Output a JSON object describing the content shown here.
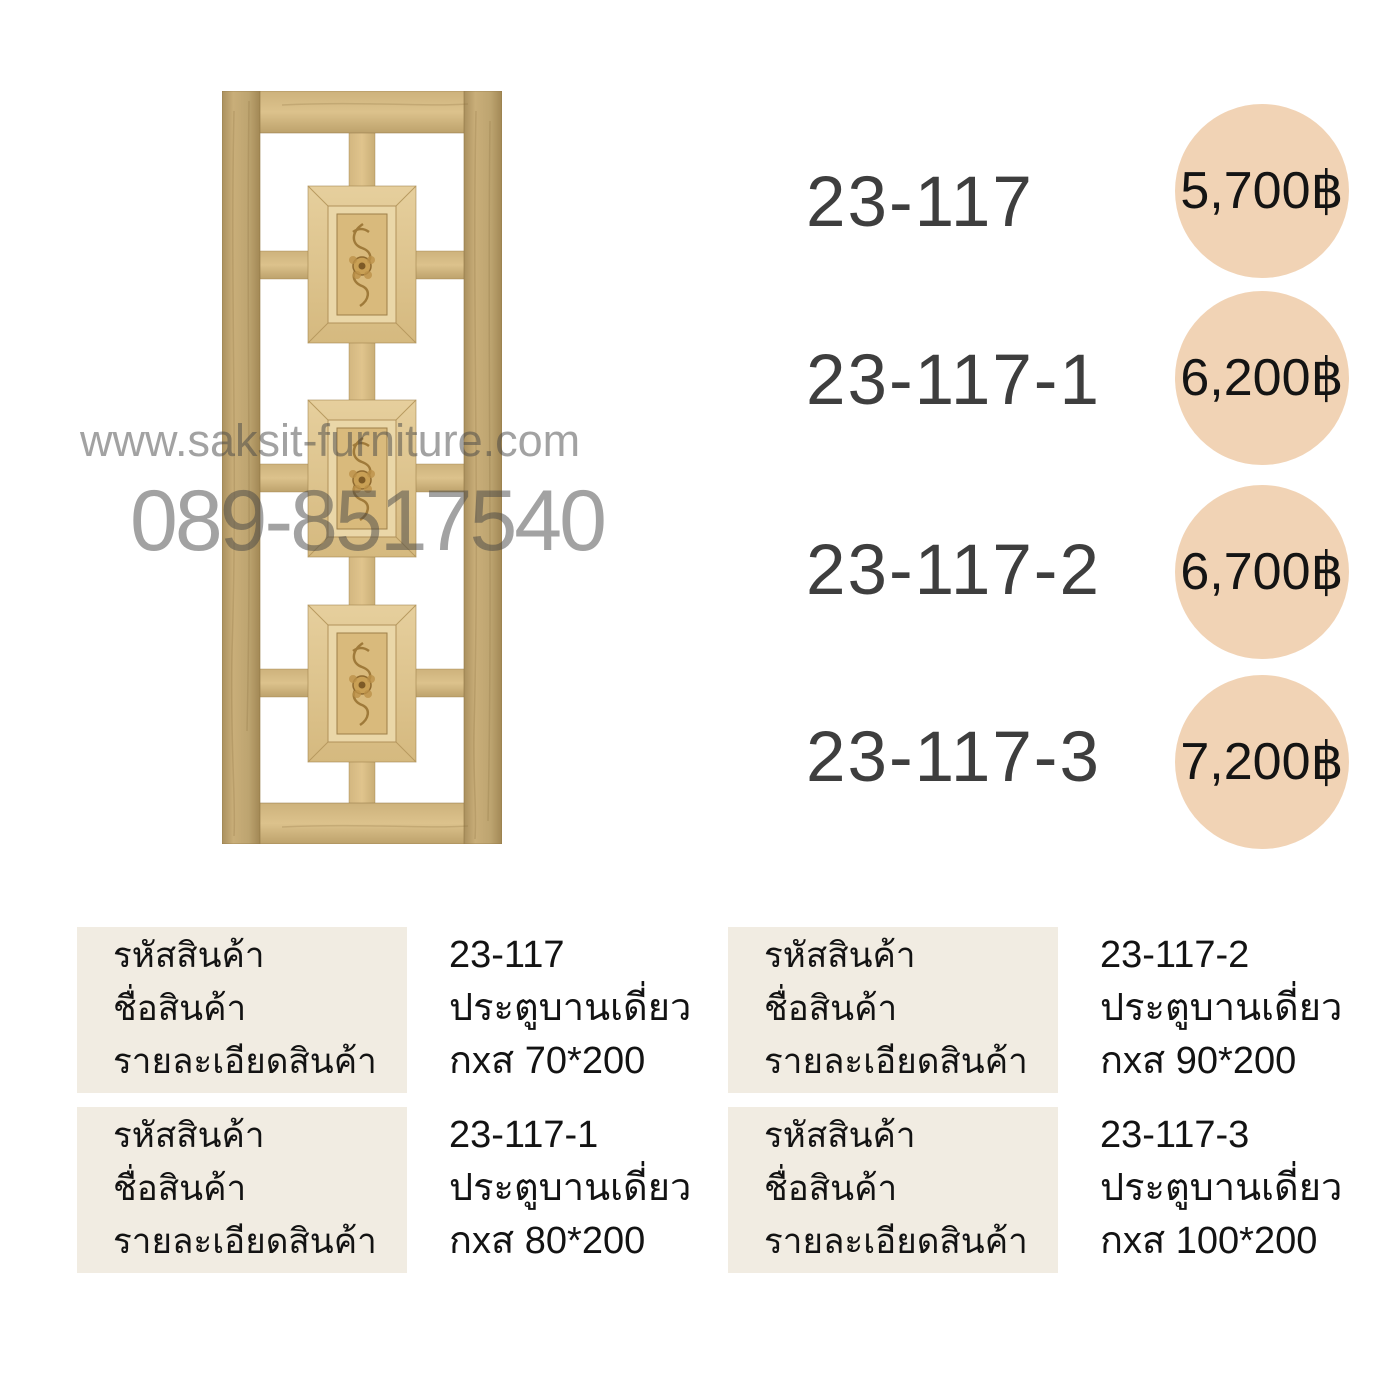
{
  "watermark": {
    "website": "www.saksit-furniture.com",
    "phone": "089-8517540"
  },
  "products": [
    {
      "code": "23-117",
      "price": "5,700฿",
      "name": "ประตูบานเดี่ยว",
      "detail": "กxส 70*200"
    },
    {
      "code": "23-117-1",
      "price": "6,200฿",
      "name": "ประตูบานเดี่ยว",
      "detail": "กxส 80*200"
    },
    {
      "code": "23-117-2",
      "price": "6,700฿",
      "name": "ประตูบานเดี่ยว",
      "detail": "กxส 90*200"
    },
    {
      "code": "23-117-3",
      "price": "7,200฿",
      "name": "ประตูบานเดี่ยว",
      "detail": "กxส 100*200"
    }
  ],
  "spec_labels": {
    "code": "รหัสสินค้า",
    "name": "ชื่อสินค้า",
    "detail": "รายละเอียดสินค้า"
  },
  "colors": {
    "price_circle": "#f1d3b5",
    "label_box": "#f1ece2",
    "code_text": "#3e3e3e",
    "watermark": "#9c9c9c",
    "wood": "#d6ba82"
  }
}
